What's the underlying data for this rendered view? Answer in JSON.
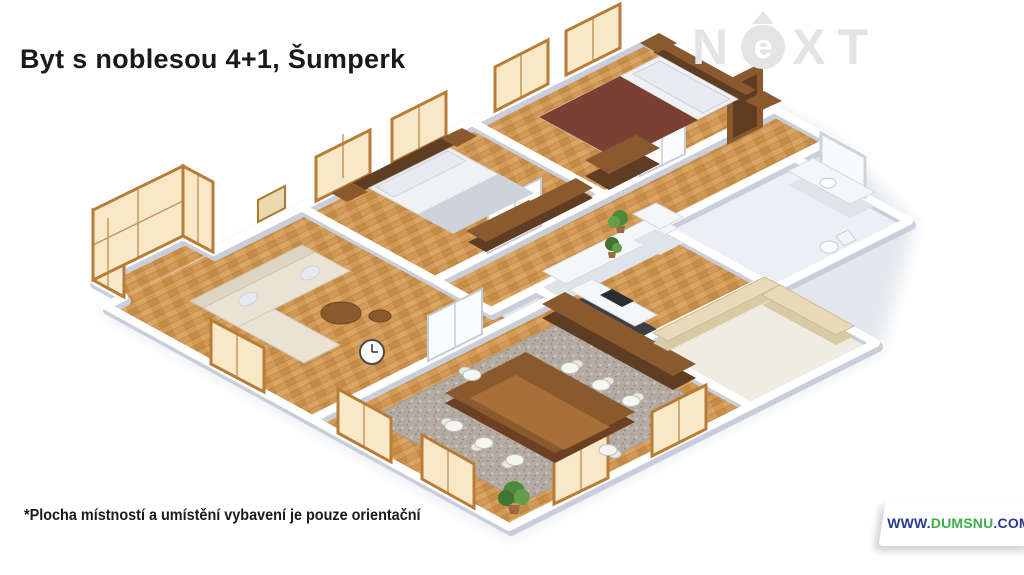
{
  "page": {
    "width": 1024,
    "height": 575,
    "background": "#ffffff"
  },
  "header": {
    "title": "Byt s noblesou 4+1, Šumperk"
  },
  "watermark": {
    "icon": "next-logo",
    "letters_pre": "N",
    "letter_circled": "e",
    "letters_post": "XT",
    "arrow": "up-arrow"
  },
  "footnote": {
    "text": "*Plocha místností a umístění vybavení je pouze orientační"
  },
  "website_badge": {
    "prefix": "WWW.",
    "brand": "DUMSNU",
    "suffix": ".COM"
  },
  "floorplan": {
    "type": "isometric-3d-floor-plan",
    "rooms": [
      "living-room",
      "bedroom-1",
      "bedroom-2",
      "hallway",
      "kitchen",
      "dining-room",
      "bathroom",
      "loggia",
      "bay-window"
    ],
    "furniture": [
      "corner-sofa",
      "coffee-table",
      "double-bed-1",
      "double-bed-2",
      "wardrobe",
      "dining-table",
      "dining-chairs",
      "sideboard",
      "kitchen-cabinets",
      "refrigerator",
      "bathroom-vanity",
      "toilet",
      "wall-clock",
      "potted-plants"
    ]
  },
  "colors": {
    "page-bg": "#ffffff",
    "title-text": "#1a1a1a",
    "watermark-gray": "#e4e4e6",
    "badge-navy": "#2b3990",
    "badge-green": "#3fae49",
    "badge-bg": "#ffffff",
    "wall-white": "#ffffff",
    "wall-shade": "#c9cfda",
    "wood-mid": "#d29a56",
    "wood-dark": "#b97f3e",
    "wood-line": "#a96e2e",
    "window-frame": "#b97c38",
    "window-glass": "#f7e9c8",
    "furniture-dark-wood": "#5f3d22",
    "furniture-mid-wood": "#8a5a2e",
    "sofa-cream": "#eae3d3",
    "bed-white": "#f0f1f3",
    "blanket-gray": "#ccd3db",
    "blanket-red": "#7a4034",
    "rug-gray": "#b3aaa2",
    "chair-white": "#f5f5f2",
    "tile-light": "#eceff3",
    "plant-green": "#4e8a3e",
    "shadow-soft": "#c9d0da"
  }
}
